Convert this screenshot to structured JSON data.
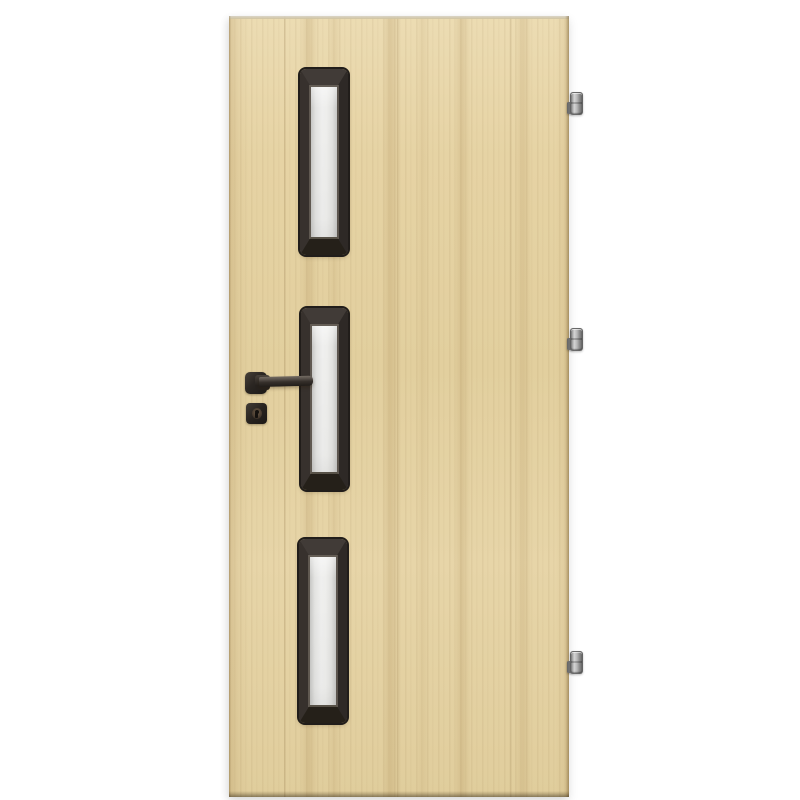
{
  "scene": {
    "type": "product-photo",
    "subject": "Interior wooden door in light oak finish with three vertical frosted-glass panels framed in dark wood, a black square-rosette lever handle with keyhole escutcheon on the left, and three silver barrel hinges on the right edge",
    "background_color": "#ffffff"
  },
  "colors": {
    "background": "#ffffff",
    "wood-base": "#e6d3a4",
    "wood-grain": "#c3a671",
    "wood-light": "#ecdcb3",
    "door-edge": "#b89c66",
    "frame-dark": "#211d1a",
    "frame-bevel-top": "#413b37",
    "frame-bevel-side": "#2e2926",
    "frame-bevel-bottom": "#252019",
    "glass-light": "#efefee",
    "glass-shade": "#c7c7c5",
    "hardware-black": "#262220",
    "hinge-metal": "#b7b7b7"
  },
  "door": {
    "glazing_panel_count": 3,
    "hinge_count": 3,
    "handle_side": "left",
    "hinge_side": "right",
    "glass_finish": "frosted",
    "handle_parts": [
      "square rosette",
      "straight lever",
      "keyhole escutcheon"
    ]
  }
}
